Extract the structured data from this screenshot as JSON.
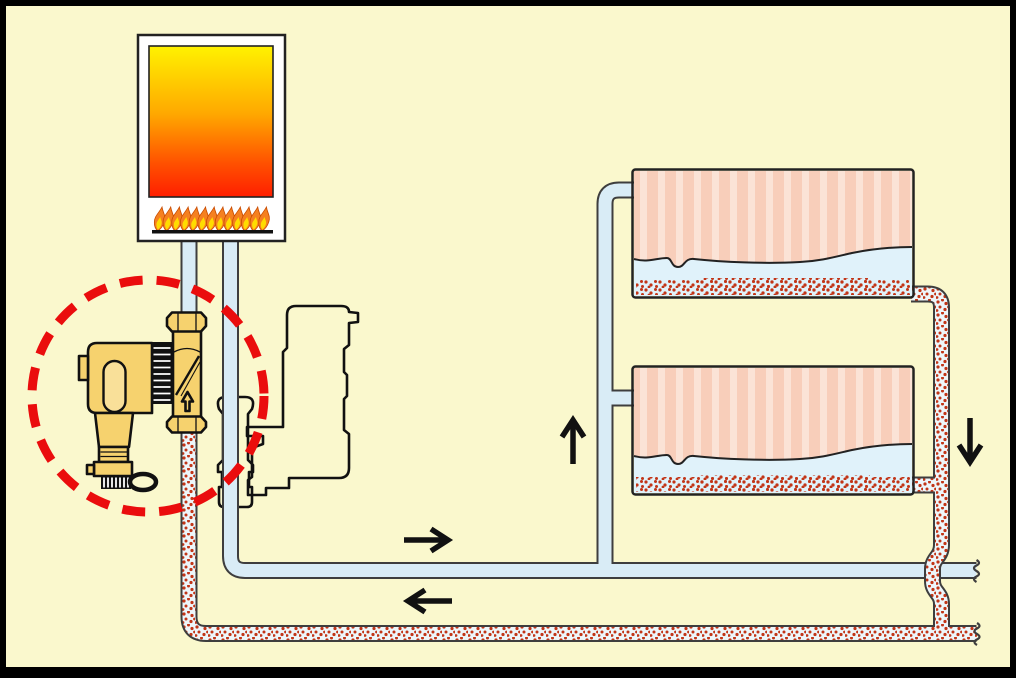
{
  "title": "Central heating system diagram with inline magnetic filter",
  "colors": {
    "bg": "#FAF8CD",
    "frame": "#000000",
    "pipe-edge": "#3E3E3E",
    "pipe-clean": "#D9ECF6",
    "dirty-bg": "#EDF6FA",
    "sludge-dot": "#C23517",
    "brass": "#F6D26E",
    "brass-light": "#F9E099",
    "outline": "#111111",
    "rad-pink": "#F8CEBA",
    "rad-pink-light": "#FBE3D6",
    "water": "#E0F2FA",
    "highlight-red": "#EA0D0D",
    "boiler-top": "#FFF200",
    "boiler-mid": "#FFA800",
    "boiler-low": "#FF5000",
    "boiler-bottom": "#FF1E00",
    "flame-outer": "#F58020",
    "flame-inner": "#FFDC00",
    "casing": "#FFFFFF"
  },
  "components": {
    "boiler": {
      "label": "Boiler"
    },
    "pump": {
      "label": "Circulation pump outline"
    },
    "filter": {
      "label": "Magnetic filter",
      "flow_direction": "up"
    },
    "radiators": [
      {
        "label": "Radiator 1",
        "state": "sludge settled at bottom"
      },
      {
        "label": "Radiator 2",
        "state": "sludge settled at bottom"
      }
    ],
    "flow_arrows": [
      {
        "direction": "right"
      },
      {
        "direction": "left"
      },
      {
        "direction": "up"
      },
      {
        "direction": "down"
      }
    ]
  }
}
